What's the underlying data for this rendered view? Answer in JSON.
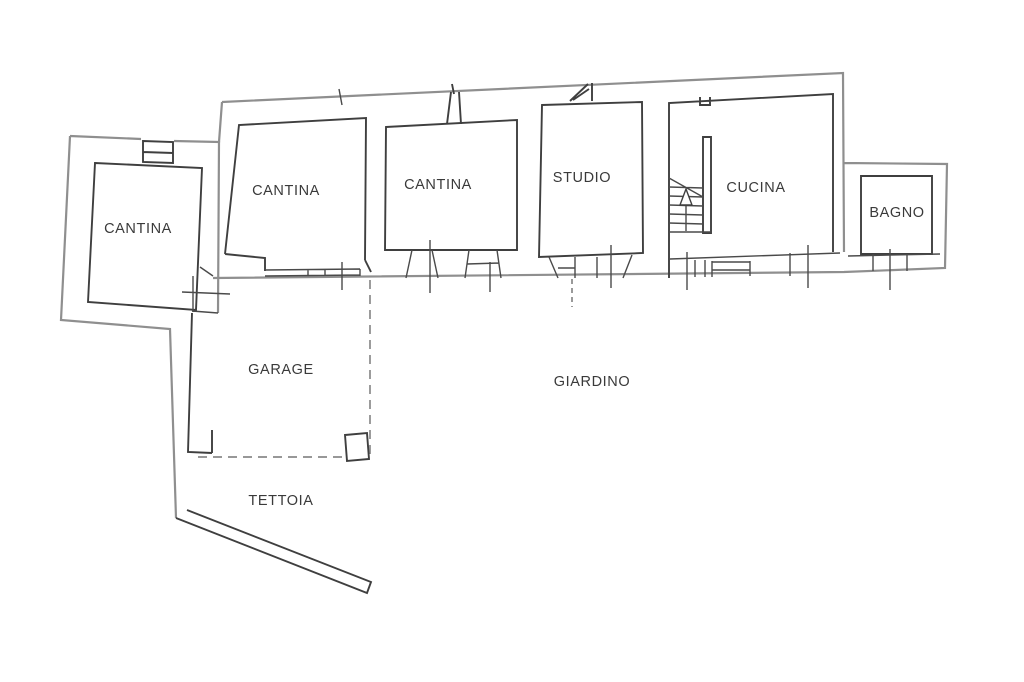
{
  "plan": {
    "type": "floor-plan",
    "colors": {
      "background": "#ffffff",
      "wall_dark": "#3f3f3f",
      "wall_gray": "#8f8f8f",
      "text": "#3a3a3a"
    },
    "rooms": [
      {
        "id": "cantina-left",
        "label": "CANTINA"
      },
      {
        "id": "cantina-mid",
        "label": "CANTINA"
      },
      {
        "id": "cantina-right",
        "label": "CANTINA"
      },
      {
        "id": "studio",
        "label": "STUDIO"
      },
      {
        "id": "cucina",
        "label": "CUCINA"
      },
      {
        "id": "bagno",
        "label": "BAGNO"
      },
      {
        "id": "garage",
        "label": "GARAGE"
      },
      {
        "id": "giardino",
        "label": "GIARDINO"
      },
      {
        "id": "tettoia",
        "label": "TETTOIA"
      }
    ]
  }
}
